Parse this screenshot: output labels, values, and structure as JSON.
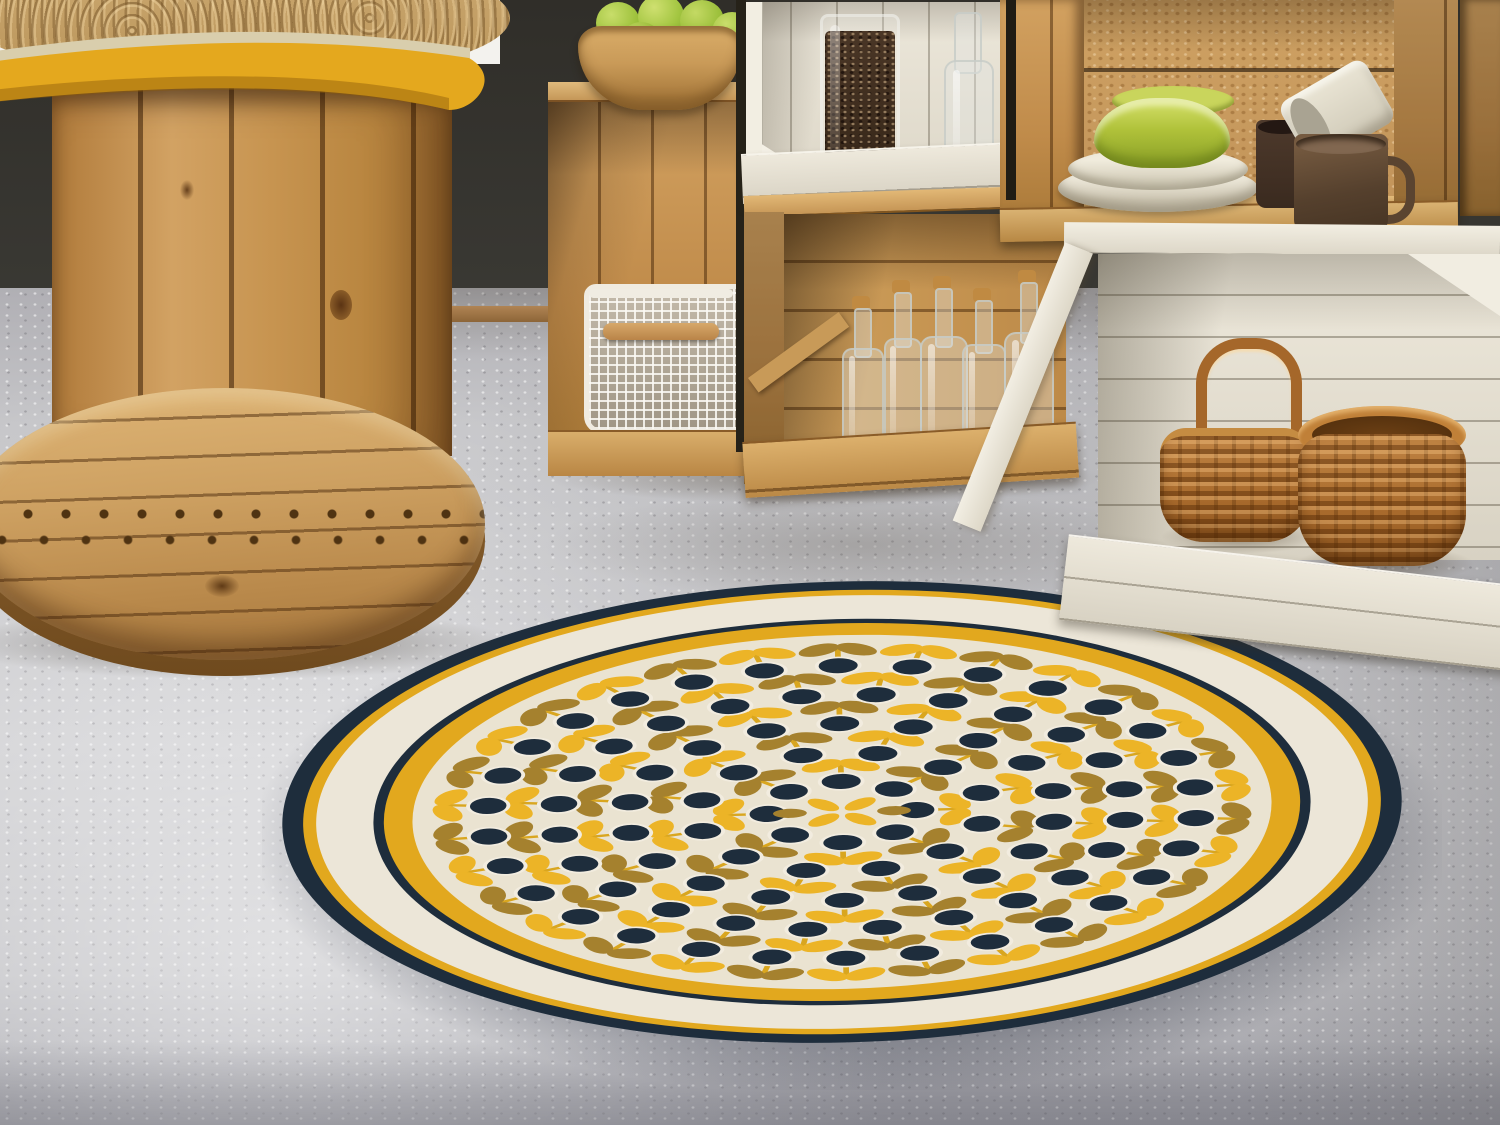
{
  "meta": {
    "description": "Kitchen corner photo: wooden cable-spool table with yellow painted rim, stacked crate shelving with kitchenware, and a round retro flower-pattern vinyl rug on a concrete floor"
  },
  "scene": {
    "background": {
      "wall_color": "#37352f",
      "white_corner": "#f3f2ee",
      "floor_color": "#c6c6c9",
      "floor_dark_band": "#9c9ca4",
      "baseboard": "#b08454"
    },
    "table": {
      "name": "cable-spool-table",
      "rim_paint": "#e4a81e",
      "pale_edge": "#d9cead",
      "rattan_mat": "#c6a36b",
      "pedestal_wood": "#c08b4a",
      "base_wood": "#cda061",
      "base_edge": "#8f6430",
      "hole_color": "#4f3312"
    },
    "crates": {
      "wood_light": "#d2a567",
      "wood_mid": "#c08b4a",
      "wood_dark": "#8a5c28",
      "white": "#ece7da",
      "white_shadow": "#c9c4b6"
    },
    "items": {
      "apple_bowl": {
        "name": "wooden-bowl-of-green-apples",
        "bowl": "#c99a58",
        "apples": "#9fc23d"
      },
      "bean_jar": {
        "name": "glass-jar-of-coffee-beans",
        "beans": "#3f2d1f",
        "glass": "rgba(240,240,235,0.55)"
      },
      "clear_bottle": {
        "name": "clear-glass-bottle",
        "glass": "rgba(228,232,228,0.38)"
      },
      "corked_bottles": {
        "name": "five-corked-glass-bottles",
        "cork": "#c08a42"
      },
      "wire_basket": {
        "name": "white-mesh-basket-with-wood-handle",
        "frame": "#f0ebe0",
        "handle": "#c9985c"
      },
      "green_bowls": {
        "name": "two-green-bowls",
        "color": "#b0c23a"
      },
      "white_plates": {
        "name": "two-white-shallow-bowls",
        "color": "#e2dccb"
      },
      "dark_mug": {
        "name": "small-espresso-mug",
        "color": "#42limit3024"
      },
      "brown_mug": {
        "name": "brown-mug",
        "color": "#55402d"
      },
      "white_mug": {
        "name": "tilted-white-mug",
        "color": "#ddd8c8"
      },
      "basket_small": {
        "name": "wicker-basket-with-handle",
        "color": "#b5772f"
      },
      "basket_large": {
        "name": "round-wicker-basket",
        "color": "#a86a2c"
      }
    },
    "rug": {
      "name": "round-retro-flower-vinyl-rug",
      "center": {
        "x": 842,
        "y": 812
      },
      "scale": {
        "x": 1.302,
        "y": 0.536
      },
      "rotate": -1.5,
      "radius": 430,
      "rings": [
        {
          "name": "outer-navy-edge",
          "r": 430,
          "color": "#1e2d3c"
        },
        {
          "name": "outer-yellow",
          "r": 414,
          "color": "#e2a81e"
        },
        {
          "name": "border-cream",
          "r": 404,
          "color": "#ece6d8"
        },
        {
          "name": "inner-navy",
          "r": 360,
          "color": "#1e2d3c"
        },
        {
          "name": "inner-yellow",
          "r": 352,
          "color": "#e2a81e"
        },
        {
          "name": "pattern-field",
          "r": 330,
          "color": "#eae3d1"
        }
      ],
      "flower": {
        "head": "#1e2d3c",
        "halo": "#f2ecdf",
        "leaf_yellow": "#ecb427",
        "leaf_olive": "#a5812e",
        "stem": "#d9a61f"
      },
      "flower_rings": [
        {
          "r": 80,
          "count": 8
        },
        {
          "r": 134,
          "count": 12
        },
        {
          "r": 188,
          "count": 18
        },
        {
          "r": 242,
          "count": 24
        },
        {
          "r": 296,
          "count": 30
        }
      ],
      "center_motif": {
        "petals": 4,
        "petal_color": "#ecb427",
        "side_color": "#a5812e"
      }
    }
  }
}
